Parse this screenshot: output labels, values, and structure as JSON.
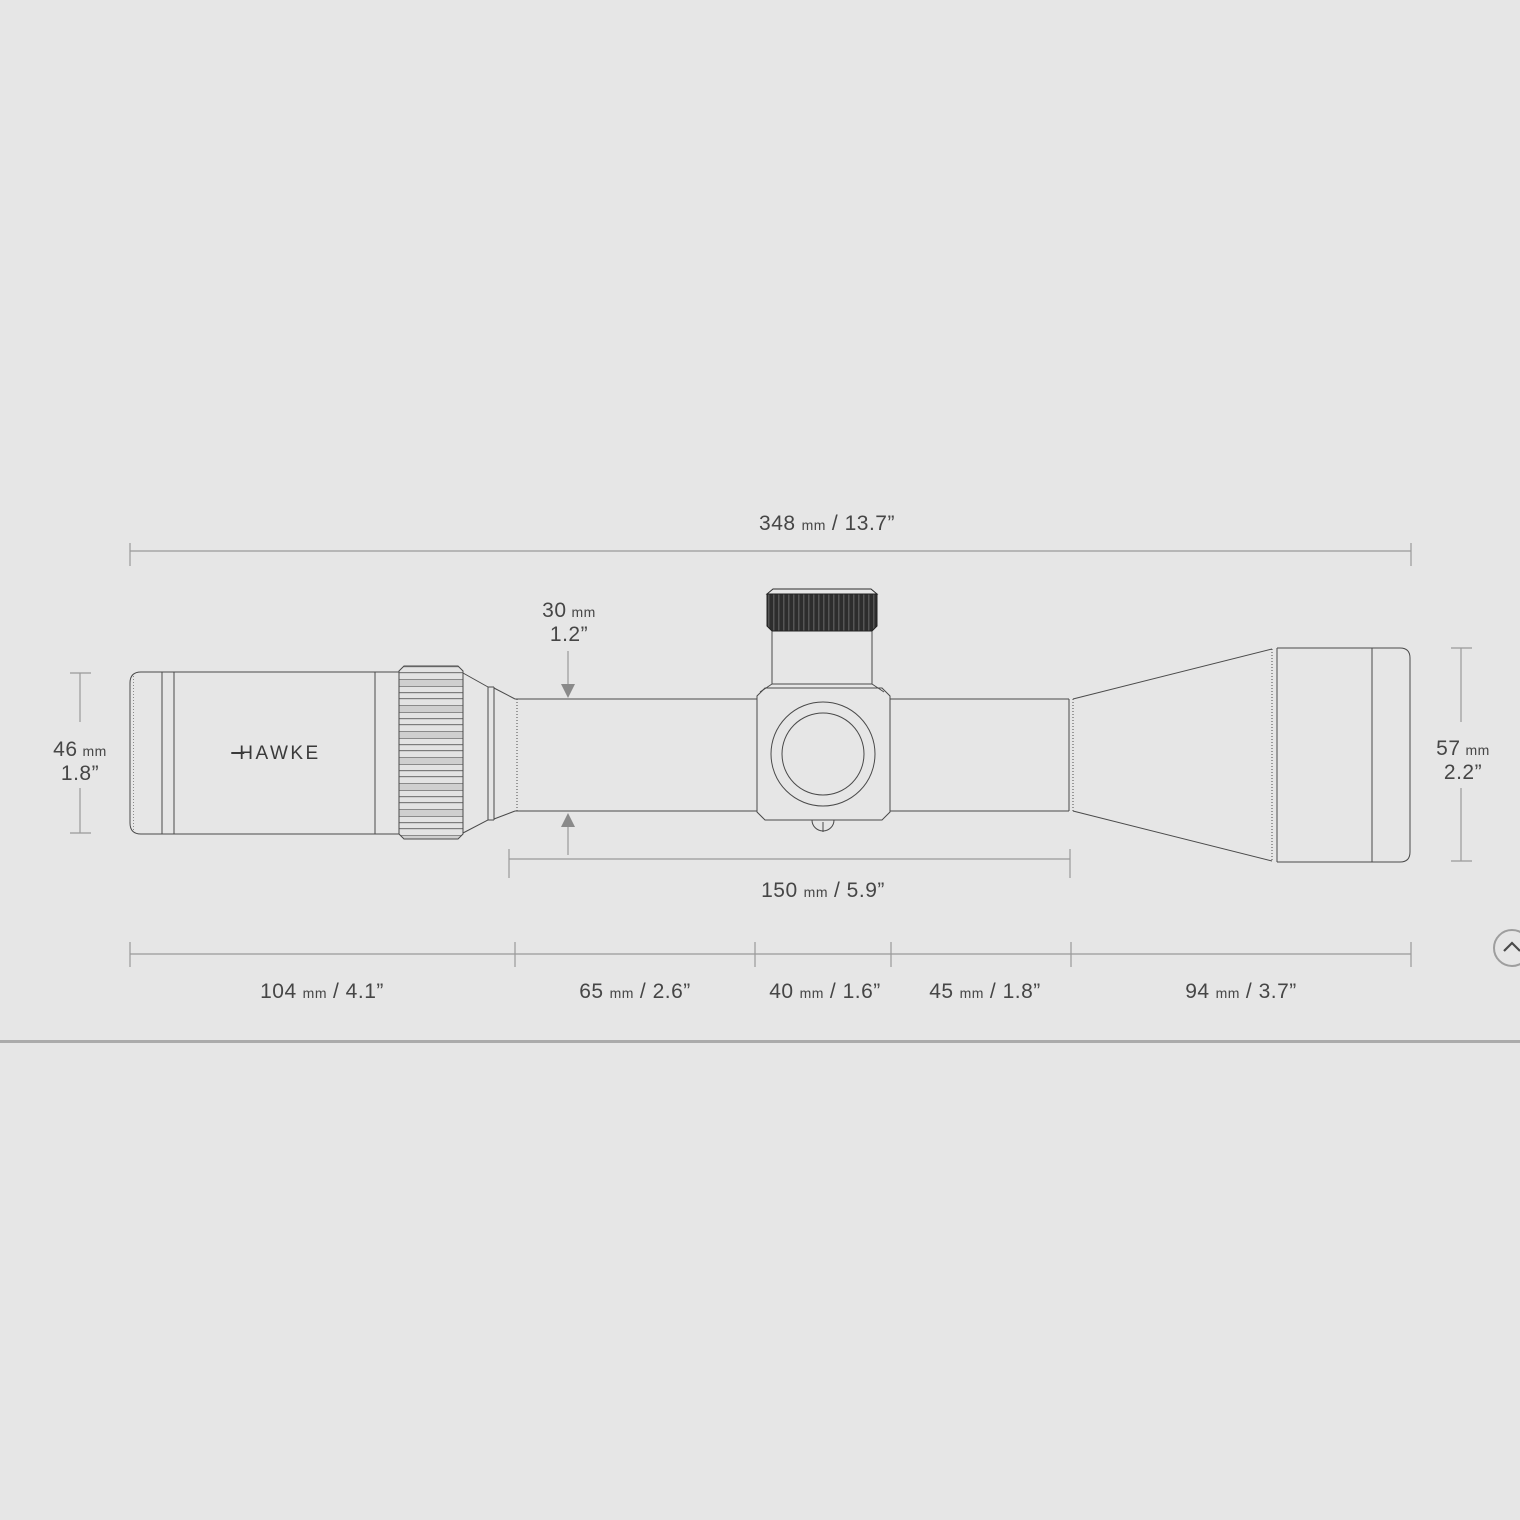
{
  "colors": {
    "background": "#e6e6e6",
    "drawing_line": "#4a4a4a",
    "dimension_line": "#9a9a9a",
    "text": "#464646",
    "divider": "#ababab",
    "turret_cap": "#2d2d2d"
  },
  "brand": {
    "logo_text": "HAWKE"
  },
  "diagram": {
    "overall_length": {
      "value": "348",
      "unit": "mm",
      "secondary": "/ 13.7”"
    },
    "tube_diameter": {
      "value": "30",
      "unit": "mm",
      "secondary": "1.2”"
    },
    "eyepiece_outer_diameter": {
      "value": "46",
      "unit": "mm",
      "secondary": "1.8”"
    },
    "objective_outer_diameter": {
      "value": "57",
      "unit": "mm",
      "secondary": "2.2”"
    },
    "mounting_length": {
      "value": "150",
      "unit": "mm",
      "secondary": "/ 5.9”"
    },
    "section_lengths": [
      {
        "value": "104",
        "unit": "mm",
        "secondary": "/ 4.1”"
      },
      {
        "value": "65",
        "unit": "mm",
        "secondary": "/ 2.6”"
      },
      {
        "value": "40",
        "unit": "mm",
        "secondary": "/ 1.6”"
      },
      {
        "value": "45",
        "unit": "mm",
        "secondary": "/ 1.8”"
      },
      {
        "value": "94",
        "unit": "mm",
        "secondary": "/ 3.7”"
      }
    ]
  },
  "controls": {
    "scroll_to_top": {
      "icon": "chevron-up-icon"
    }
  }
}
